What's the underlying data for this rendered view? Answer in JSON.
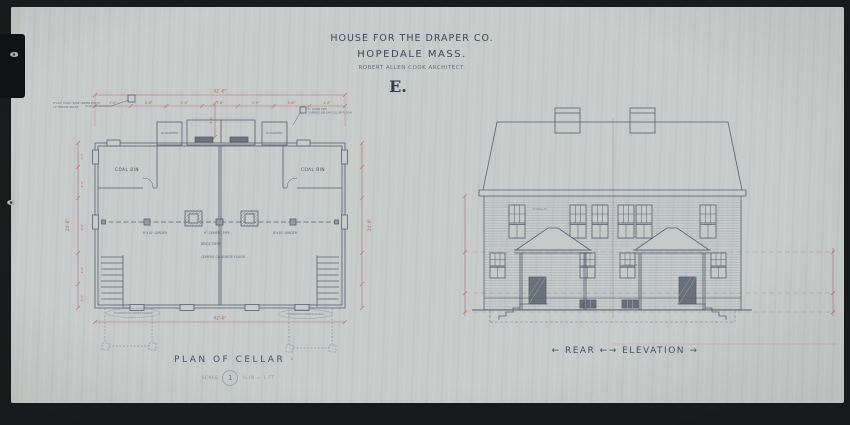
{
  "page": {
    "paper_color": "#c7cbca",
    "background_color": "#191c1d",
    "ink_color": "#454e5e",
    "dimension_color": "#b25752",
    "stamp_blue": "#5a6e9e"
  },
  "title_block": {
    "company_line": "HOUSE FOR THE DRAPER CO.",
    "location_line": "HOPEDALE MASS.",
    "architect_line": "ROBERT ALLEN COOK ARCHITECT.",
    "sheet_letter": "E."
  },
  "plan": {
    "caption": "PLAN OF CELLAR ·",
    "scale_prefix": "SCALE",
    "sheet_number": "1",
    "scale_suffix": "¼ IN = 1 FT",
    "labels": {
      "coal_bin_left": "COAL BIN",
      "coal_bin_right": "COAL BIN",
      "no_basement_left": "NO BASEMENT",
      "no_basement_right": "NO BASEMENT",
      "girder_left": "8\"x10\" GIRDER",
      "girder_right": "8\"x10\" GIRDER",
      "cement_pipe": "6\" CEMENT PIPE",
      "brick_piers": "BRICK PIERS",
      "floor_note": "CEMENT CONCRETE FLOOR",
      "note_left_1": "8\"x12\" CONC. BASE UNDER POSTS",
      "note_left_2": "12\" BELOW GRADE",
      "note_right_1": "6\" DRAIN PIPE",
      "note_right_2": "CARRIED BELOW CELLAR FLOOR",
      "pier_note_left": "FOUNDATION UNDER PIAZZA",
      "pier_note_right": "FOUNDATION UNDER PIAZZA"
    },
    "dims": {
      "overall_top": "42'-6\"",
      "overall_bottom": "42'-6\"",
      "segments": [
        "4'-6\"",
        "8'-6\"",
        "5'-6\"",
        "7'-6\"",
        "5'-6\"",
        "8'-6\"",
        "4'-6\""
      ],
      "left_overall": "24'-0\"",
      "right_overall": "24'-0\"",
      "left_segments": [
        "3'-6\"",
        "4'-6\"",
        "8'-0\"",
        "4'-6\"",
        "3'-6\""
      ],
      "center_vertical": "4'-0\""
    }
  },
  "elevation": {
    "caption": "← REAR ←→ ELEVATION →",
    "material_note_upper": "SHINGLES",
    "material_note_lower": "SHINGLES"
  }
}
